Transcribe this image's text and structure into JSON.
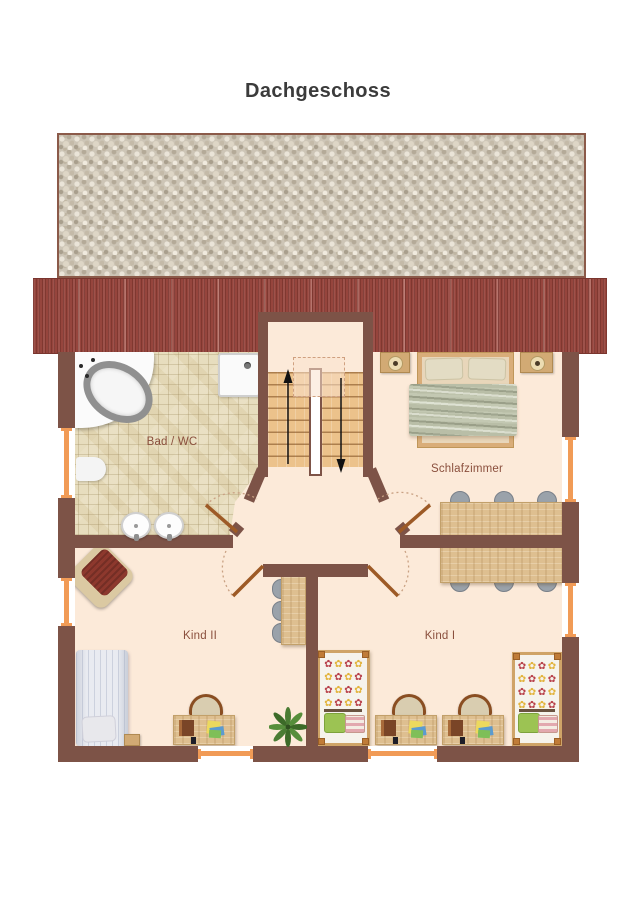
{
  "page": {
    "title": "Dachgeschoss"
  },
  "rooms": [
    {
      "id": "bad-wc",
      "label": "Bad / WC"
    },
    {
      "id": "schlafzimmer",
      "label": "Schlafzimmer"
    },
    {
      "id": "kind-2",
      "label": "Kind II"
    },
    {
      "id": "kind-1",
      "label": "Kind I"
    }
  ],
  "flowers": {
    "glyph": "✿",
    "colors": [
      "#b8414b",
      "#e2b33c"
    ]
  },
  "colors": {
    "wall": "#7d5347",
    "roof_band": "#96453d",
    "floor": "#fcead9",
    "bathroom_tile": "#e7ddbe",
    "window_marker": "#f19b56",
    "door_leaf": "#9d5a26",
    "stair_wood": "#ecc28b",
    "table_wood": "#debf90",
    "blanket": "#b9bea7",
    "armchair_cushion": "#8d382d",
    "pillow_green": "#9cc353",
    "chair_gray": "#9aa2aa",
    "label_text": "#8a4f3d",
    "title_text": "#3b3b3b"
  },
  "furniture": {
    "bad_wc": [
      "corner-bathtub",
      "shower-tray",
      "toilet",
      "washbasin",
      "washbasin"
    ],
    "flur": [
      "staircase-up",
      "staircase-down"
    ],
    "schlafzimmer": [
      "double-bed",
      "nightstand-lamp",
      "nightstand-lamp",
      "table-six-chairs"
    ],
    "kind_2": [
      "armchair",
      "single-bed",
      "nightstand",
      "desk-with-chair",
      "side-table-three-chairs",
      "plant"
    ],
    "kind_1": [
      "single-bed",
      "single-bed",
      "desk-with-chair",
      "desk-with-chair"
    ]
  }
}
